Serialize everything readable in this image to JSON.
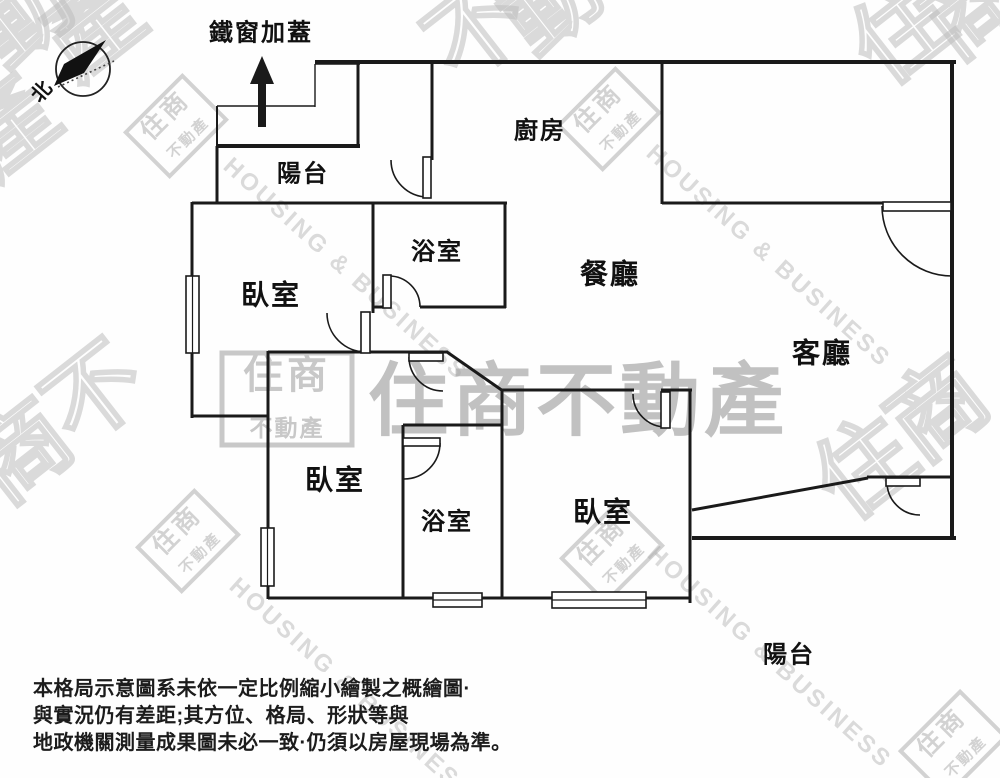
{
  "canopy": {
    "label": "鐵窗加蓋",
    "x": 261,
    "y": 33,
    "size": 24,
    "arrow": {
      "head": "262,56 250,84 274,84",
      "shaft": [
        258,
        83,
        8,
        44
      ]
    }
  },
  "compass": {
    "label": "北",
    "cx": 83,
    "cy": 69,
    "r": 27,
    "needle": "106,40 64,64 54,86 84,73",
    "dotted_line": [
      58,
      87,
      114,
      61
    ],
    "label_x": 42,
    "label_y": 92,
    "label_rot": -48
  },
  "rooms": [
    {
      "id": "balcony-top",
      "label": "陽台",
      "x": 303,
      "y": 174,
      "size": 24
    },
    {
      "id": "kitchen",
      "label": "廚房",
      "x": 540,
      "y": 131,
      "size": 24
    },
    {
      "id": "bathroom-1",
      "label": "浴室",
      "x": 437,
      "y": 252,
      "size": 24
    },
    {
      "id": "bedroom-1",
      "label": "臥室",
      "x": 271,
      "y": 295,
      "size": 28
    },
    {
      "id": "dining-room",
      "label": "餐廳",
      "x": 610,
      "y": 274,
      "size": 28
    },
    {
      "id": "living-room",
      "label": "客廳",
      "x": 822,
      "y": 353,
      "size": 28
    },
    {
      "id": "bedroom-2",
      "label": "臥室",
      "x": 335,
      "y": 480,
      "size": 28
    },
    {
      "id": "bathroom-2",
      "label": "浴室",
      "x": 447,
      "y": 522,
      "size": 24
    },
    {
      "id": "bedroom-3",
      "label": "臥室",
      "x": 603,
      "y": 512,
      "size": 28
    },
    {
      "id": "balcony-bottom",
      "label": "陽台",
      "x": 789,
      "y": 655,
      "size": 24
    }
  ],
  "floorplan": {
    "wall_color": "#1a1a1a",
    "walls": [
      [
        315,
        62,
        956,
        62,
        4
      ],
      [
        952,
        62,
        952,
        539,
        4
      ],
      [
        358,
        62,
        358,
        148,
        3
      ],
      [
        216,
        146,
        360,
        146,
        4
      ],
      [
        217,
        106,
        217,
        148,
        2
      ],
      [
        217,
        146,
        217,
        204,
        3
      ],
      [
        192,
        203,
        507,
        203,
        3
      ],
      [
        432,
        62,
        432,
        160,
        3
      ],
      [
        662,
        62,
        662,
        204,
        3
      ],
      [
        662,
        203,
        884,
        203,
        3
      ],
      [
        192,
        202,
        192,
        418,
        3
      ],
      [
        192,
        416,
        269,
        416,
        3
      ],
      [
        268,
        351,
        268,
        599,
        3
      ],
      [
        268,
        352,
        448,
        352,
        3
      ],
      [
        447,
        352,
        503,
        391,
        3
      ],
      [
        373,
        203,
        373,
        313,
        3
      ],
      [
        373,
        307,
        390,
        307,
        3
      ],
      [
        420,
        307,
        506,
        307,
        3
      ],
      [
        505,
        203,
        505,
        308,
        3
      ],
      [
        403,
        425,
        403,
        599,
        3
      ],
      [
        403,
        425,
        503,
        425,
        3
      ],
      [
        502,
        390,
        502,
        599,
        3
      ],
      [
        502,
        390,
        634,
        390,
        3
      ],
      [
        661,
        390,
        692,
        390,
        3
      ],
      [
        690,
        390,
        690,
        603,
        3
      ],
      [
        268,
        598,
        691,
        598,
        3
      ],
      [
        692,
        510,
        868,
        478,
        3
      ],
      [
        867,
        477,
        952,
        477,
        3
      ],
      [
        692,
        538,
        956,
        538,
        4
      ]
    ],
    "thin_lines": [
      [
        217,
        106,
        315,
        106
      ],
      [
        315,
        64,
        315,
        107
      ],
      [
        315,
        64,
        360,
        64
      ]
    ],
    "doors": [
      {
        "name": "kitchen-balcony-door",
        "arc": "M 391 160 A 37 37 0 0 0 428 197",
        "leaf": [
          423,
          157,
          8,
          41
        ]
      },
      {
        "name": "entrance-door",
        "arc": "M 882 206 A 70 70 0 0 0 952 276",
        "leaf": [
          883,
          202,
          68,
          9
        ]
      },
      {
        "name": "bathroom-1-door",
        "arc": "M 389 276 A 31 31 0 0 1 420 307",
        "leaf": [
          383,
          275,
          8,
          33
        ]
      },
      {
        "name": "bedroom-1-door",
        "arc": "M 327 313 A 39 39 0 0 0 366 352",
        "leaf": [
          361,
          312,
          9,
          41
        ]
      },
      {
        "name": "bedroom-2-door",
        "arc": "M 409 357 A 34 34 0 0 0 443 391",
        "leaf": [
          409,
          353,
          34,
          8
        ]
      },
      {
        "name": "bathroom-2-door",
        "arc": "M 440 443 A 36 36 0 0 1 404 479",
        "leaf": [
          403,
          438,
          37,
          8
        ]
      },
      {
        "name": "bedroom-3-door",
        "arc": "M 633 394 A 33 33 0 0 0 666 427",
        "leaf": [
          661,
          392,
          9,
          36
        ]
      },
      {
        "name": "balcony-door",
        "arc": "M 887 482 A 33 33 0 0 0 920 515",
        "leaf": [
          886,
          478,
          34,
          8
        ]
      }
    ],
    "windows": [
      {
        "name": "bedroom-1-window",
        "rect": [
          186,
          276,
          13,
          77
        ],
        "orient": "v"
      },
      {
        "name": "bedroom-2-window",
        "rect": [
          261,
          528,
          13,
          58
        ],
        "orient": "v"
      },
      {
        "name": "bathroom-2-window",
        "rect": [
          433,
          593,
          49,
          14
        ],
        "orient": "h"
      },
      {
        "name": "bedroom-3-window",
        "rect": [
          552,
          592,
          94,
          16
        ],
        "orient": "h"
      }
    ]
  },
  "watermarks": {
    "gray": "#a8a8a8",
    "light_gray": "#bdbdbd",
    "brand_top": "住商",
    "brand_bottom": "不動產",
    "brand_full": "住商不動產",
    "slogan": "HOUSING & BUSINESS",
    "center_text": {
      "text": "住商不動產",
      "cx": 578,
      "cy": 401,
      "size": 80,
      "spacing": 4,
      "opacity": 0.7
    },
    "logos": [
      {
        "cx": 287,
        "cy": 399,
        "w": 130,
        "h": 92,
        "rot": 0,
        "opacity": 0.62,
        "big": true
      },
      {
        "cx": 176,
        "cy": 126,
        "w": 80,
        "h": 62,
        "rot": -45,
        "opacity": 0.5
      },
      {
        "cx": 609,
        "cy": 119,
        "w": 80,
        "h": 62,
        "rot": -45,
        "opacity": 0.5
      },
      {
        "cx": 612,
        "cy": 552,
        "w": 80,
        "h": 62,
        "rot": -45,
        "opacity": 0.5
      },
      {
        "cx": 188,
        "cy": 541,
        "w": 80,
        "h": 62,
        "rot": -45,
        "opacity": 0.5
      },
      {
        "cx": 953,
        "cy": 744,
        "w": 84,
        "h": 64,
        "rot": -45,
        "opacity": 0.5
      }
    ],
    "fragments": [
      {
        "t": "動",
        "x": 22,
        "y": 15
      },
      {
        "t": "產",
        "x": 93,
        "y": 28
      },
      {
        "t": "產",
        "x": 8,
        "y": 128
      },
      {
        "t": "不",
        "x": 477,
        "y": 30
      },
      {
        "t": "動",
        "x": 551,
        "y": 2
      },
      {
        "t": "住",
        "x": 902,
        "y": 33
      },
      {
        "t": "商",
        "x": 972,
        "y": 8
      },
      {
        "t": "住",
        "x": 865,
        "y": 468
      },
      {
        "t": "商",
        "x": 938,
        "y": 410
      },
      {
        "t": "商",
        "x": 22,
        "y": 452
      },
      {
        "t": "不",
        "x": 95,
        "y": 394
      }
    ],
    "slogan_bands": [
      {
        "x": 222,
        "y": 168
      },
      {
        "x": 645,
        "y": 155
      },
      {
        "x": 228,
        "y": 588
      },
      {
        "x": 646,
        "y": 556
      }
    ]
  },
  "disclaimer": {
    "lines": [
      "本格局示意圖系未依一定比例縮小繪製之概繪圖·",
      "與實況仍有差距;其方位、格局、形狀等與",
      "地政機關測量成果圖未必一致·仍須以房屋現場為準。"
    ]
  }
}
